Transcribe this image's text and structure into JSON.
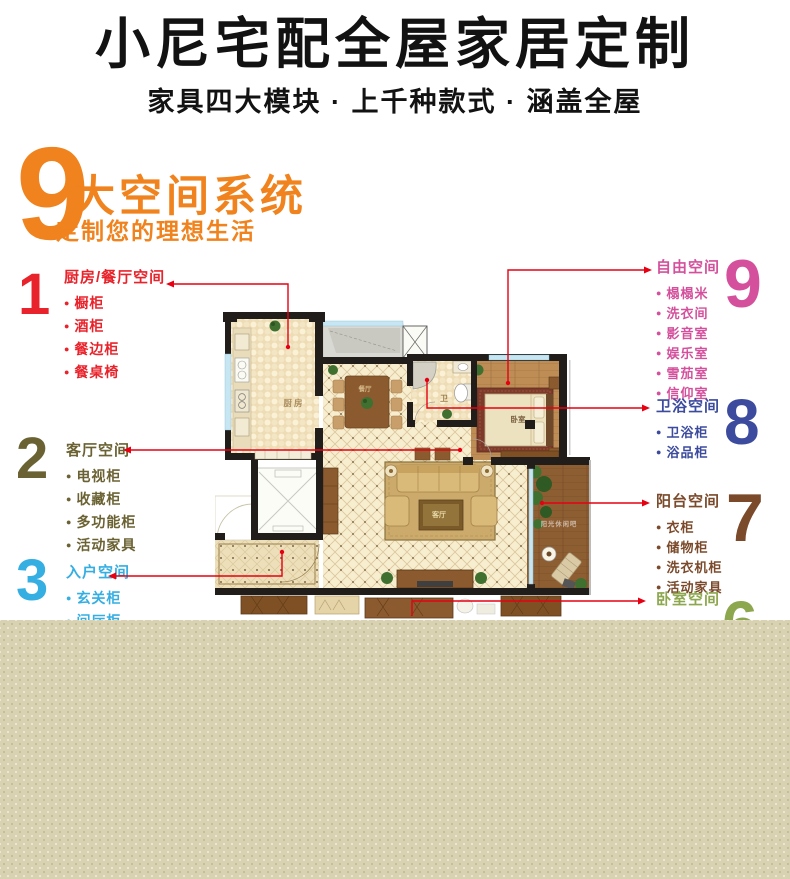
{
  "header": {
    "title": "小尼宅配全屋家居定制",
    "subtitle": "家具四大模块 · 上千种款式 · 涵盖全屋"
  },
  "hero": {
    "big_number": "9",
    "headline": "大空间系统",
    "subline": "定制您的理想生活",
    "accent_color": "#F0831E"
  },
  "spaces_left": [
    {
      "num": "1",
      "color": "#E8232B",
      "title": "厨房/餐厅空间",
      "items": [
        "橱柜",
        "酒柜",
        "餐边柜",
        "餐桌椅"
      ]
    },
    {
      "num": "2",
      "color": "#6B6233",
      "title": "客厅空间",
      "items": [
        "电视柜",
        "收藏柜",
        "多功能柜",
        "活动家具"
      ]
    },
    {
      "num": "3",
      "color": "#35AEE2",
      "title": "入户空间",
      "items": [
        "玄关柜",
        "间厅柜"
      ]
    }
  ],
  "spaces_right": [
    {
      "num": "9",
      "color": "#D4509C",
      "title": "自由空间",
      "items": [
        "榻榻米",
        "洗衣间",
        "影音室",
        "娱乐室",
        "雪茄室",
        "信仰室"
      ]
    },
    {
      "num": "8",
      "color": "#3C4B9D",
      "title": "卫浴空间",
      "items": [
        "卫浴柜",
        "浴品柜"
      ]
    },
    {
      "num": "7",
      "color": "#7B4A2B",
      "title": "阳台空间",
      "items": [
        "衣柜",
        "储物柜",
        "洗衣机柜",
        "活动家具"
      ]
    },
    {
      "num": "6",
      "color": "#8CA74D",
      "title": "卧室空间",
      "items": []
    }
  ],
  "floor_plan": {
    "labels": {
      "kitchen": "厨房",
      "dining": "餐厅",
      "bath": "卫",
      "bedroom": "卧室",
      "living": "客厅",
      "balcony": "阳光休闲吧"
    }
  },
  "colors": {
    "leader_line": "#E60012",
    "band_background": "#D8D1B2",
    "title_text": "#121212"
  }
}
